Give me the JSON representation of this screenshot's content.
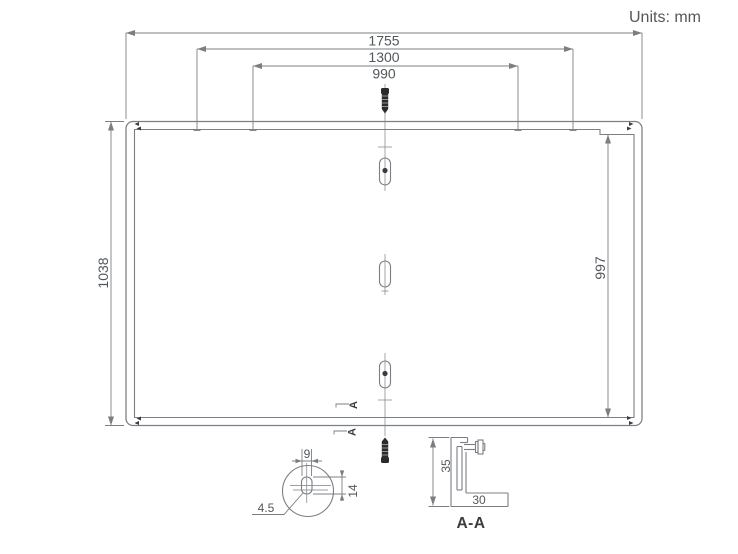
{
  "title": {
    "units": "Units: mm"
  },
  "colors": {
    "line": "#7b7f83",
    "text": "#54575a",
    "dark": "#3a3d40",
    "screw": "#2b2b2b",
    "bg": "#ffffff"
  },
  "dimensions": {
    "width_outer": "1755",
    "width_middle": "1300",
    "width_inner": "990",
    "height_outer": "1038",
    "height_inner": "997",
    "detail_slot_width": "9",
    "detail_slot_height": "14",
    "detail_slot_radius": "4.5",
    "frame_height": "35",
    "frame_base_width": "30"
  },
  "section": {
    "view_label": "A-A",
    "cut_marker_upper": "A",
    "cut_marker_lower": "A"
  }
}
